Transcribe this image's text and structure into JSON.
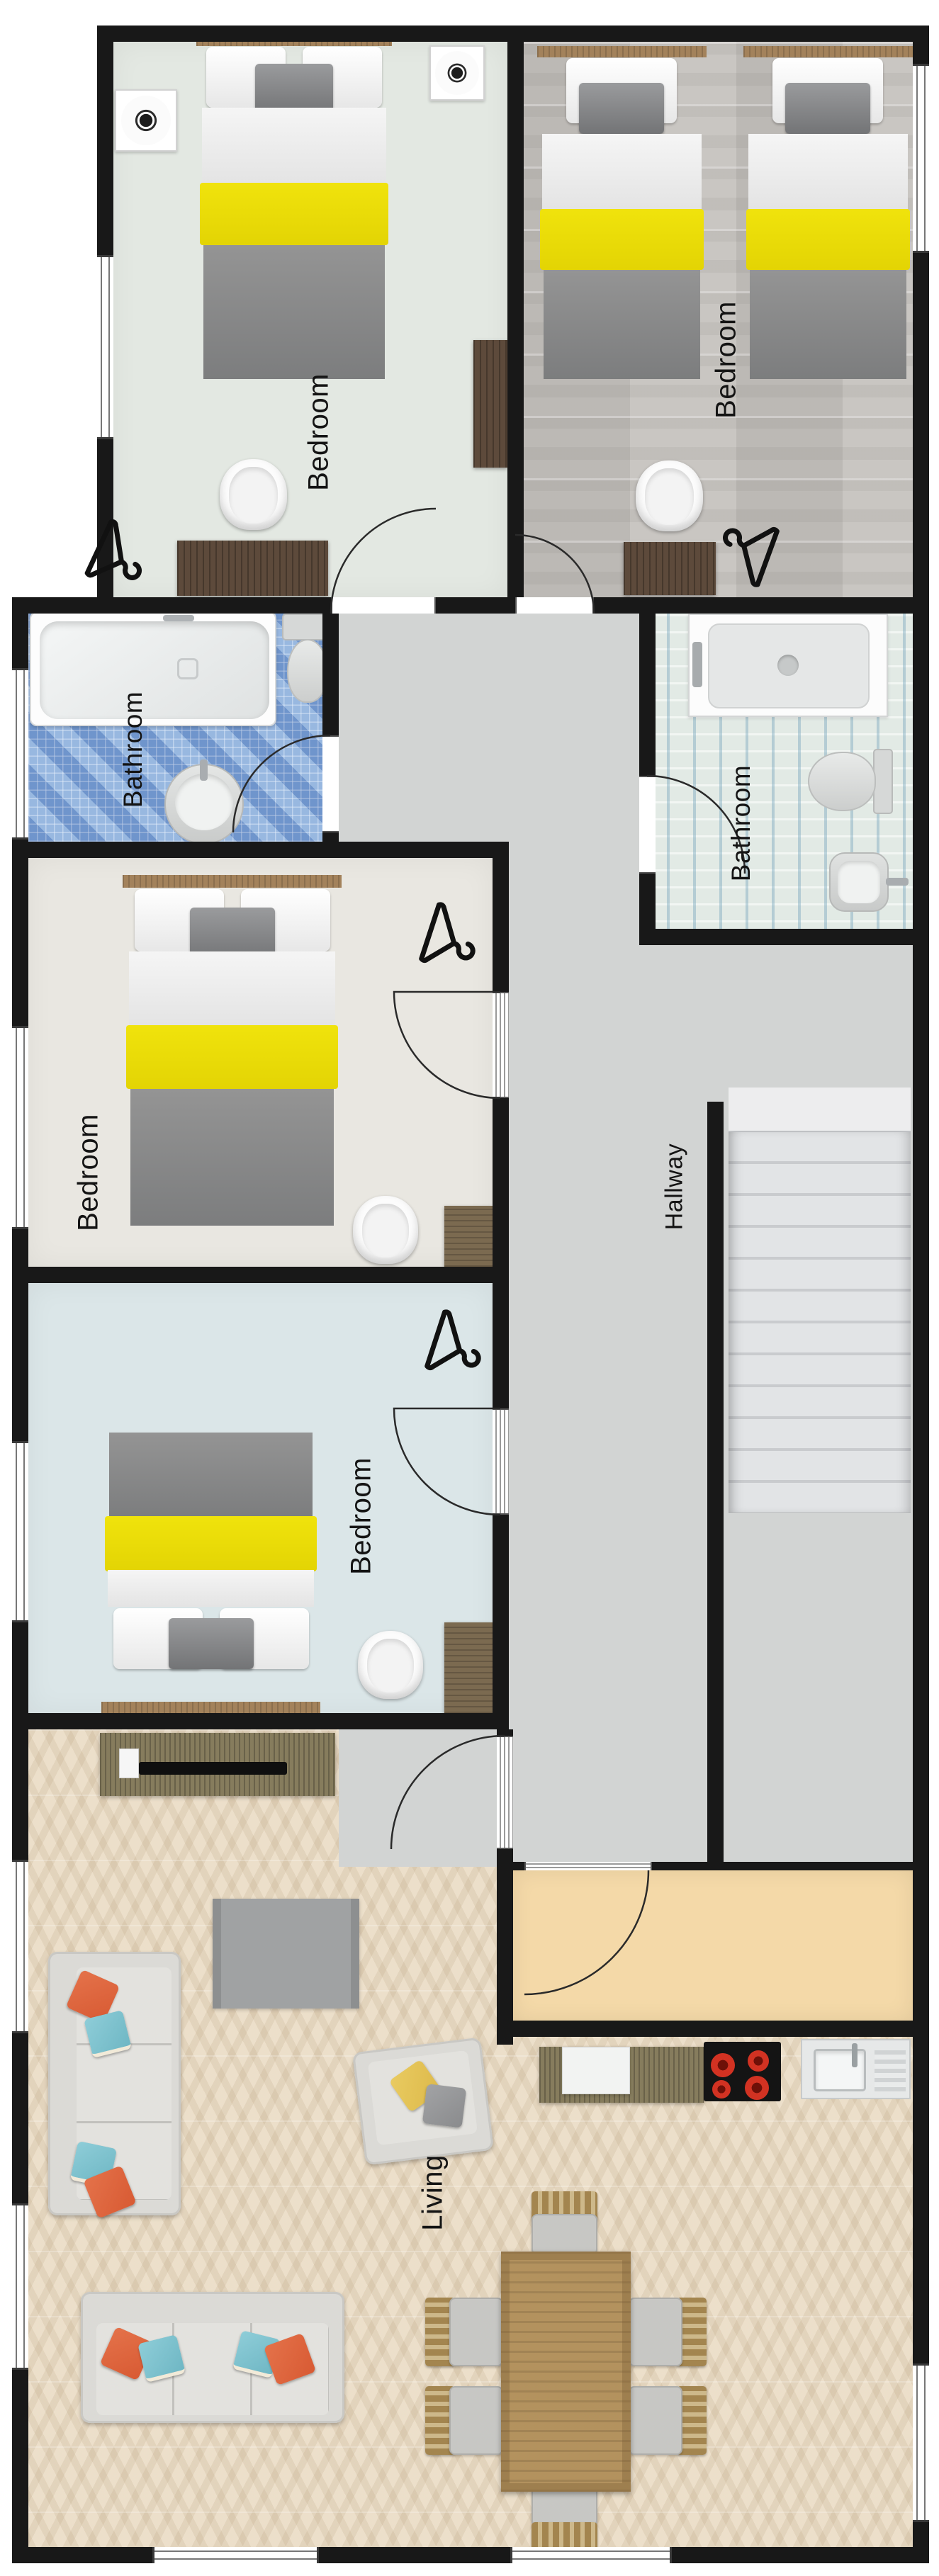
{
  "plan_title": "Apartment floor plan",
  "rooms": [
    {
      "name": "bedroom-top-left",
      "label": "Bedroom",
      "floor_color": "#e3e8e2"
    },
    {
      "name": "bedroom-top-right",
      "label": "Bedroom",
      "floor_color": "#c9c6c2"
    },
    {
      "name": "bathroom-left",
      "label": "Bathroom",
      "floor_color": "#8cacd8"
    },
    {
      "name": "bathroom-right",
      "label": "Bathroom",
      "floor_color": "#e2eae5"
    },
    {
      "name": "bedroom-middle-left",
      "label": "Bedroom",
      "floor_color": "#e9e7e1"
    },
    {
      "name": "bedroom-lower-left",
      "label": "Bedroom",
      "floor_color": "#dbe6e8"
    },
    {
      "name": "hallway",
      "label": "Hallway",
      "floor_color": "#d2d4d3"
    },
    {
      "name": "living",
      "label": "Living",
      "floor_color": "#ecdfca"
    }
  ],
  "palette": {
    "wall": "#181818",
    "bed_blanket_yellow": "#ecdf0a",
    "bed_duvet_gray": "#8a8b8c",
    "sofa_pillow_orange": "#dd6340",
    "sofa_pillow_teal": "#7fc2cf",
    "armchair_pillow_yellow": "#e3c257",
    "entry_floor_tan": "#f4d9a8",
    "stove_burner_red": "#cf2d20"
  }
}
